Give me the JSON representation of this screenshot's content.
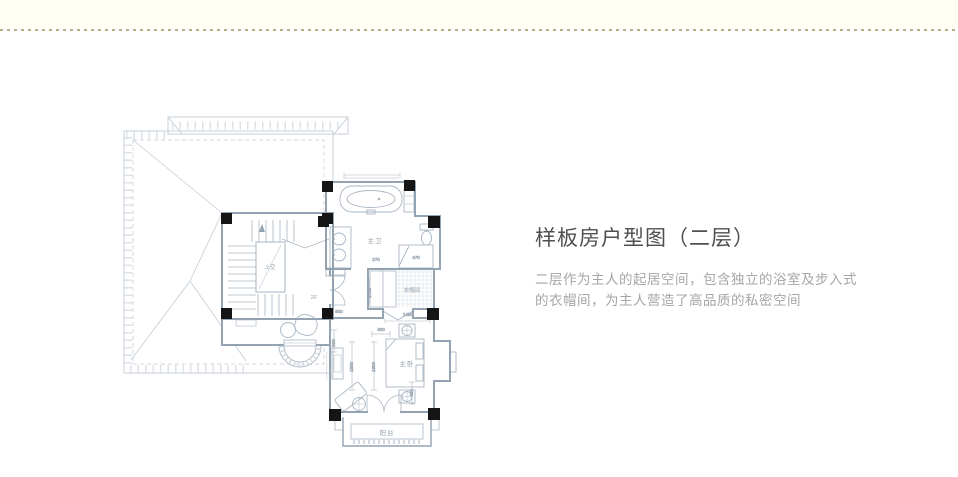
{
  "header": {
    "divider_color": "#b3b287"
  },
  "panel": {
    "title": "样板房户型图（二层）",
    "desc_line1": "二层作为主人的起居空间，包含独立的浴室及步入式",
    "desc_line2": "的衣帽间，为主人营造了高品质的私密空间"
  },
  "floorplan": {
    "rooms": {
      "master_bath": "主卫",
      "walk_in_closet": "衣帽间",
      "master_bedroom": "主卧",
      "balcony": "阳台",
      "void_above": "上空",
      "floor_tag": "2F"
    },
    "dimensions": {
      "bath_door": "270",
      "closet_depth": "1700",
      "shower_width": "470",
      "closet_door": "1450",
      "bed_gap": "400",
      "bed_len_a": "1500",
      "bed_len_b": "1600",
      "nightstand": "450",
      "hall_opening": "500",
      "wall_offset": "500"
    },
    "colors": {
      "wall": "#93a3b2",
      "line": "#a9b6c3",
      "roof": "#c2ccd6",
      "column": "#151515",
      "label": "#94a1ae",
      "dimension": "#9aa7b3"
    }
  }
}
